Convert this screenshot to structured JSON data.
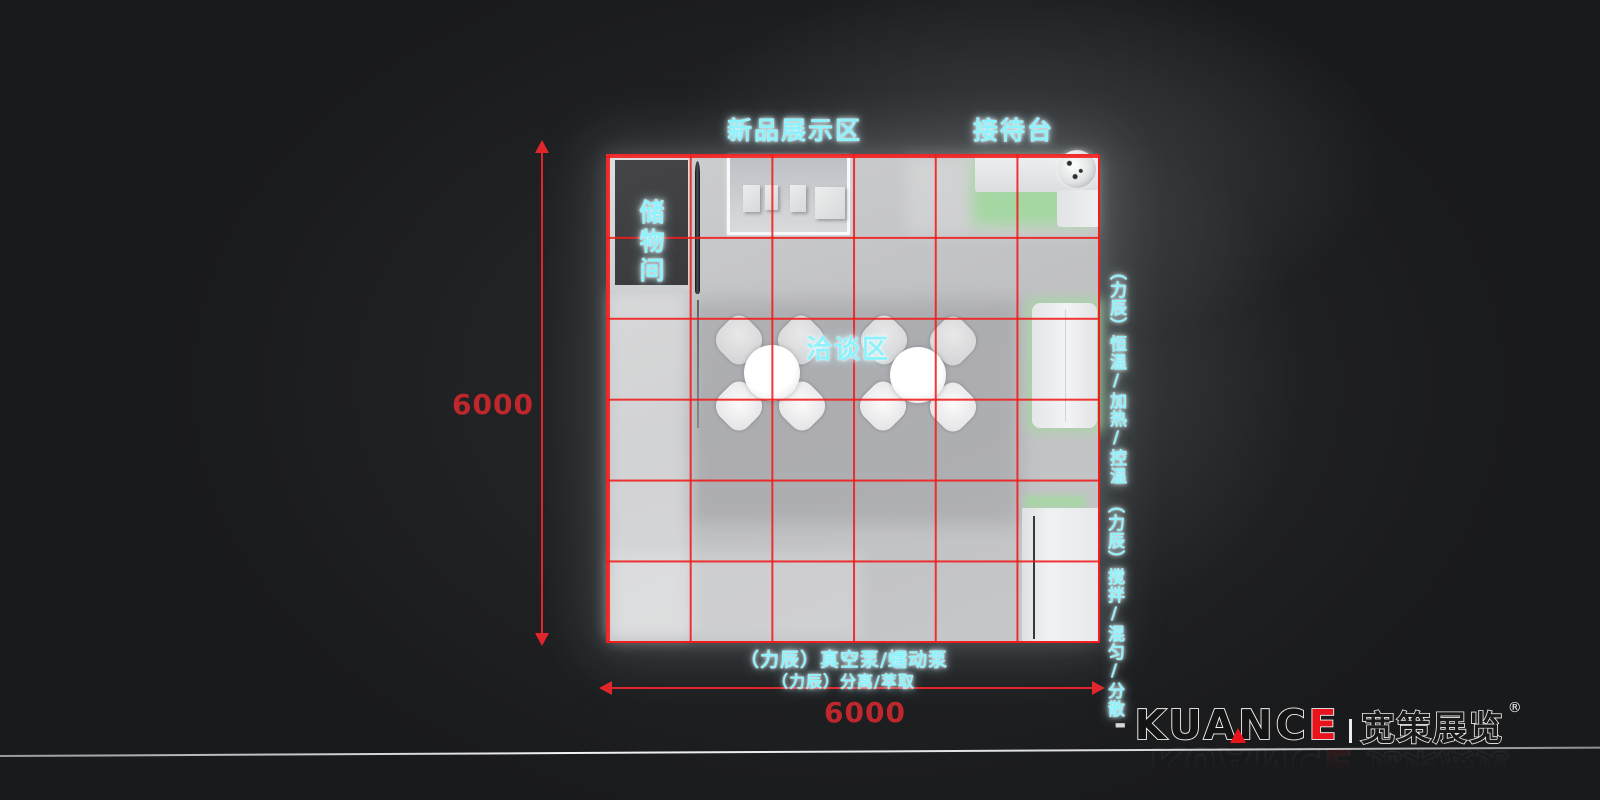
{
  "zones": {
    "display": "新品展示区",
    "reception": "接待台",
    "storage": "储物间",
    "meeting": "洽谈区"
  },
  "annotations": {
    "right_top": "（力辰）恒温/加热/控温",
    "right_bottom": "（力辰）搅拌/混匀/分散",
    "bottom_line1": "（力辰）真空泵/蠕动泵",
    "bottom_line2": "（力辰）分离/萃取"
  },
  "dimensions": {
    "width_label": "6000",
    "height_label": "6000"
  },
  "logo": {
    "dash": "-",
    "brand_black": "KUANC",
    "brand_red": "E",
    "brand_cn": "宽策展览",
    "registered": "®"
  },
  "colors": {
    "grid_red": "#f11a1a",
    "dimension_red": "#bf272c",
    "label_cyan": "#8ef2fc",
    "accent_green": "#a5d8a2",
    "logo_red": "#e8131b",
    "background": "#191a1c"
  }
}
